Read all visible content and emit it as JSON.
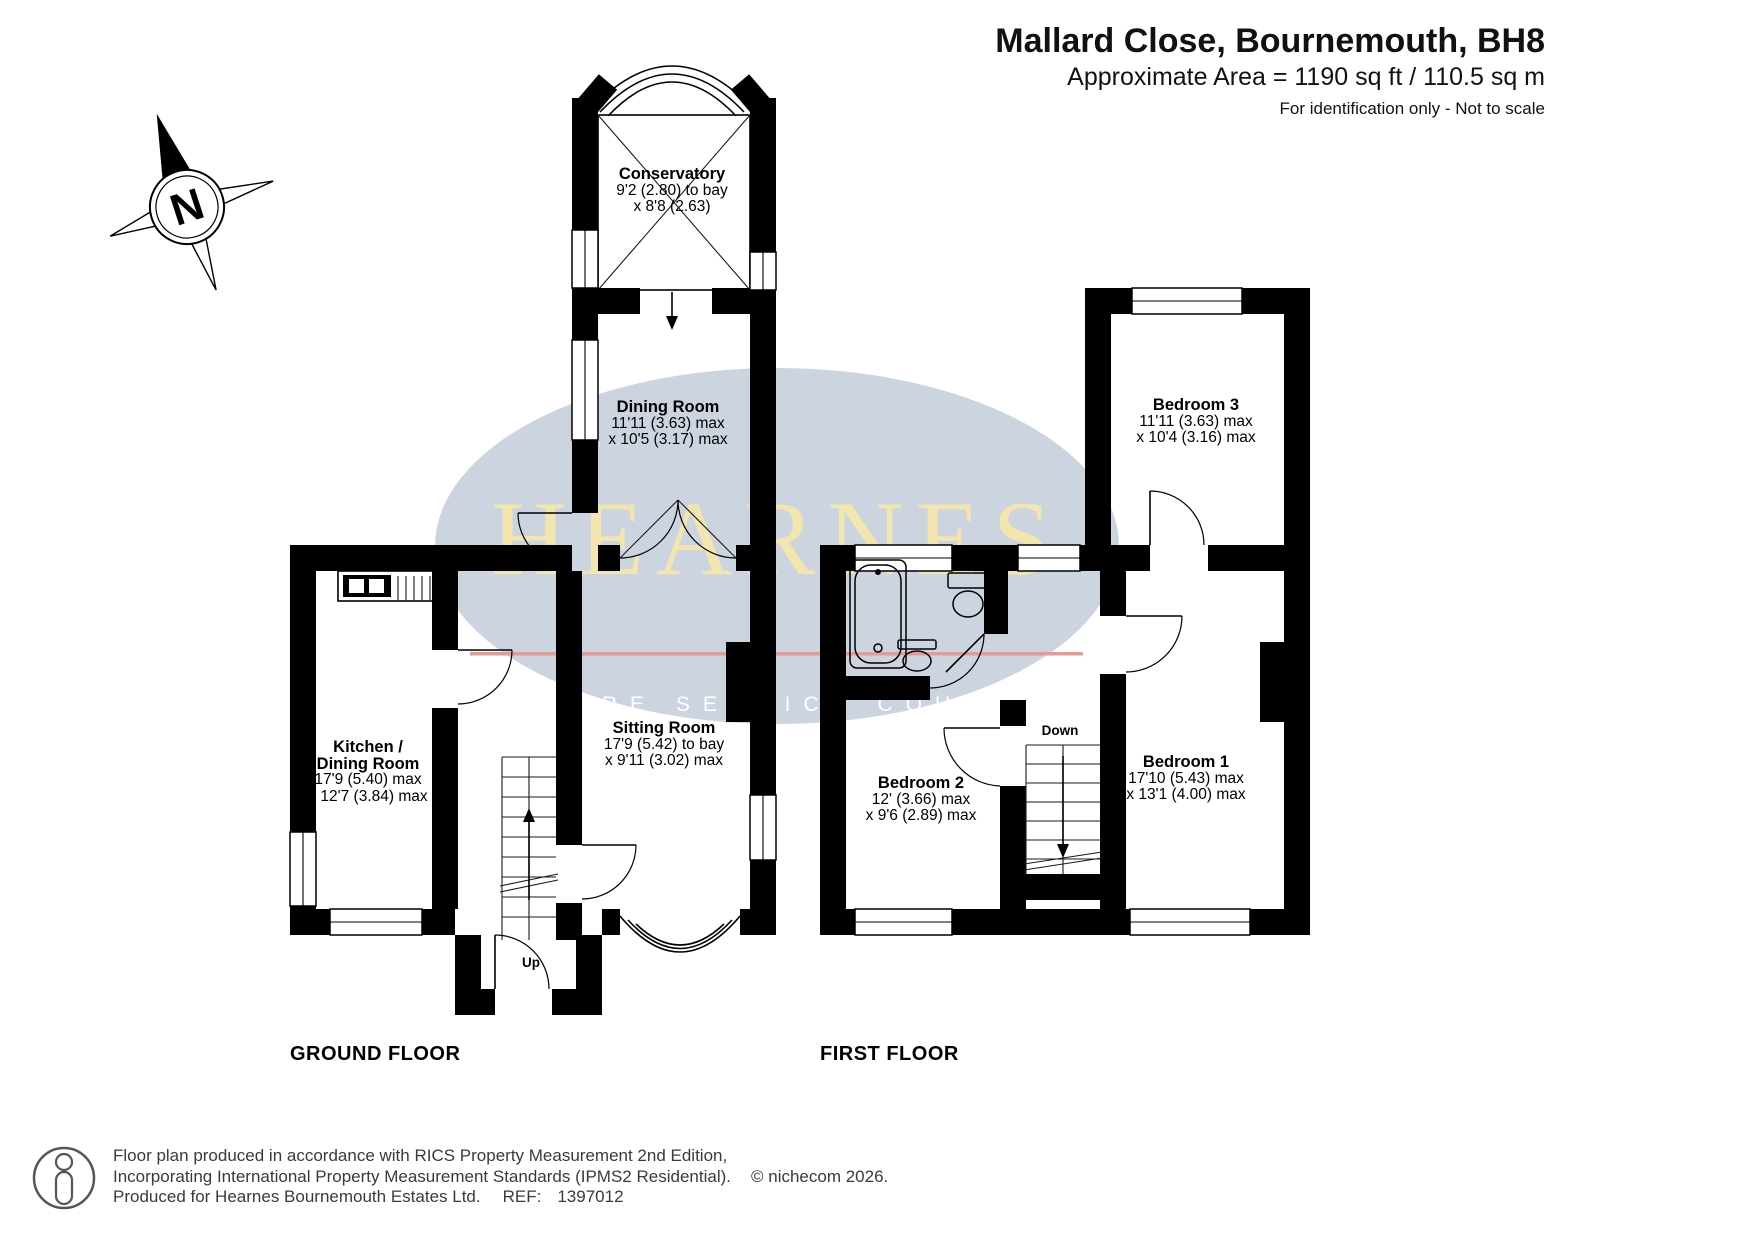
{
  "header": {
    "title": "Mallard Close, Bournemouth, BH8",
    "area": "Approximate Area = 1190 sq ft / 110.5 sq m",
    "disclaimer": "For identification only - Not to scale"
  },
  "compass": {
    "label": "N"
  },
  "floors": [
    {
      "id": "ground",
      "label": "GROUND FLOOR",
      "stairs_label": "Up",
      "rooms": [
        {
          "key": "conservatory",
          "lines": [
            "Conservatory",
            "9'2 (2.80) to bay",
            "x 8'8 (2.63)"
          ]
        },
        {
          "key": "dining-room",
          "lines": [
            "Dining Room",
            "11'11 (3.63) max",
            "x 10'5 (3.17) max"
          ]
        },
        {
          "key": "kitchen-dining-room",
          "lines": [
            "Kitchen /",
            "Dining Room",
            "17'9 (5.40) max",
            "x 12'7 (3.84) max"
          ]
        },
        {
          "key": "sitting-room",
          "lines": [
            "Sitting Room",
            "17'9 (5.42) to bay",
            "x 9'11 (3.02) max"
          ]
        }
      ]
    },
    {
      "id": "first",
      "label": "FIRST FLOOR",
      "stairs_label": "Down",
      "rooms": [
        {
          "key": "bedroom-3",
          "lines": [
            "Bedroom 3",
            "11'11 (3.63) max",
            "x 10'4 (3.16) max"
          ]
        },
        {
          "key": "bedroom-2",
          "lines": [
            "Bedroom 2",
            "12' (3.66) max",
            "x 9'6 (2.89) max"
          ]
        },
        {
          "key": "bedroom-1",
          "lines": [
            "Bedroom 1",
            "17'10 (5.43) max",
            "x 13'1 (4.00) max"
          ]
        }
      ]
    }
  ],
  "watermark": {
    "brand": "HEARNES",
    "tagline": "WHERE SERVICE COUNTS",
    "ellipse_color": "#ccd4e0",
    "brand_color": "#f2e5ad",
    "line_color": "#e59a94",
    "tagline_color": "#ffffff"
  },
  "wall_color": "#000000",
  "footer": {
    "line1": "Floor plan produced in accordance with RICS Property Measurement 2nd Edition,",
    "line2": "Incorporating International Property Measurement Standards (IPMS2 Residential).",
    "copyright": "© nichecom 2026.",
    "line3": "Produced for Hearnes Bournemouth Estates Ltd.",
    "ref_label": "REF:",
    "ref_value": "1397012"
  }
}
